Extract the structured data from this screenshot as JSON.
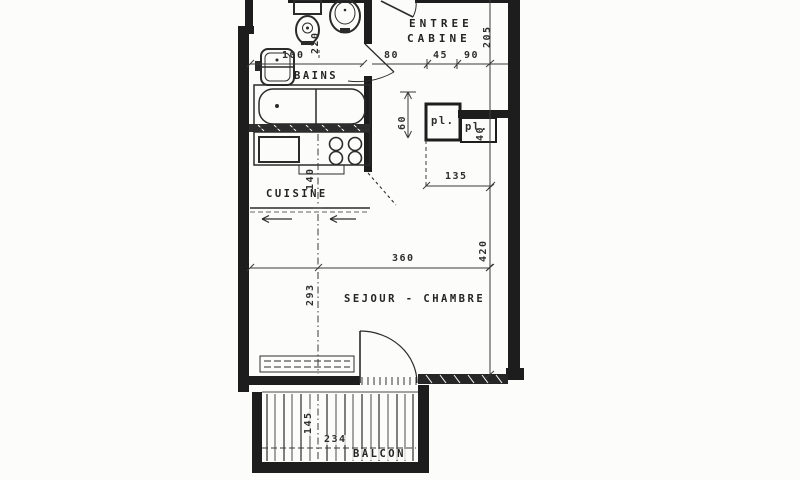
{
  "plan": {
    "labels": {
      "entree_line1": "ENTREE",
      "entree_line2": "CABINE",
      "bains": "BAINS",
      "cuisine": "CUISINE",
      "sejour": "SEJOUR - CHAMBRE",
      "balcon": "BALCON",
      "closet1": "pl.",
      "closet2": "pl."
    },
    "dims": {
      "bains_width": "100",
      "wc_zone_depth": "220",
      "entree_seg_a": "80",
      "entree_seg_b": "45",
      "entree_seg_c": "90",
      "entree_depth": "205",
      "closet_offset": "60",
      "closet2_depth": "40",
      "closets_width": "135",
      "cuisine_depth": "140",
      "sejour_depth": "293",
      "sejour_width": "360",
      "apartment_depth": "420",
      "balcon_depth": "145",
      "balcon_width": "234"
    },
    "colors": {
      "ink": "#1d1d1d",
      "line": "#2b2b2b",
      "dimline": "#3a3a3a",
      "paper": "#fcfcfa"
    }
  }
}
